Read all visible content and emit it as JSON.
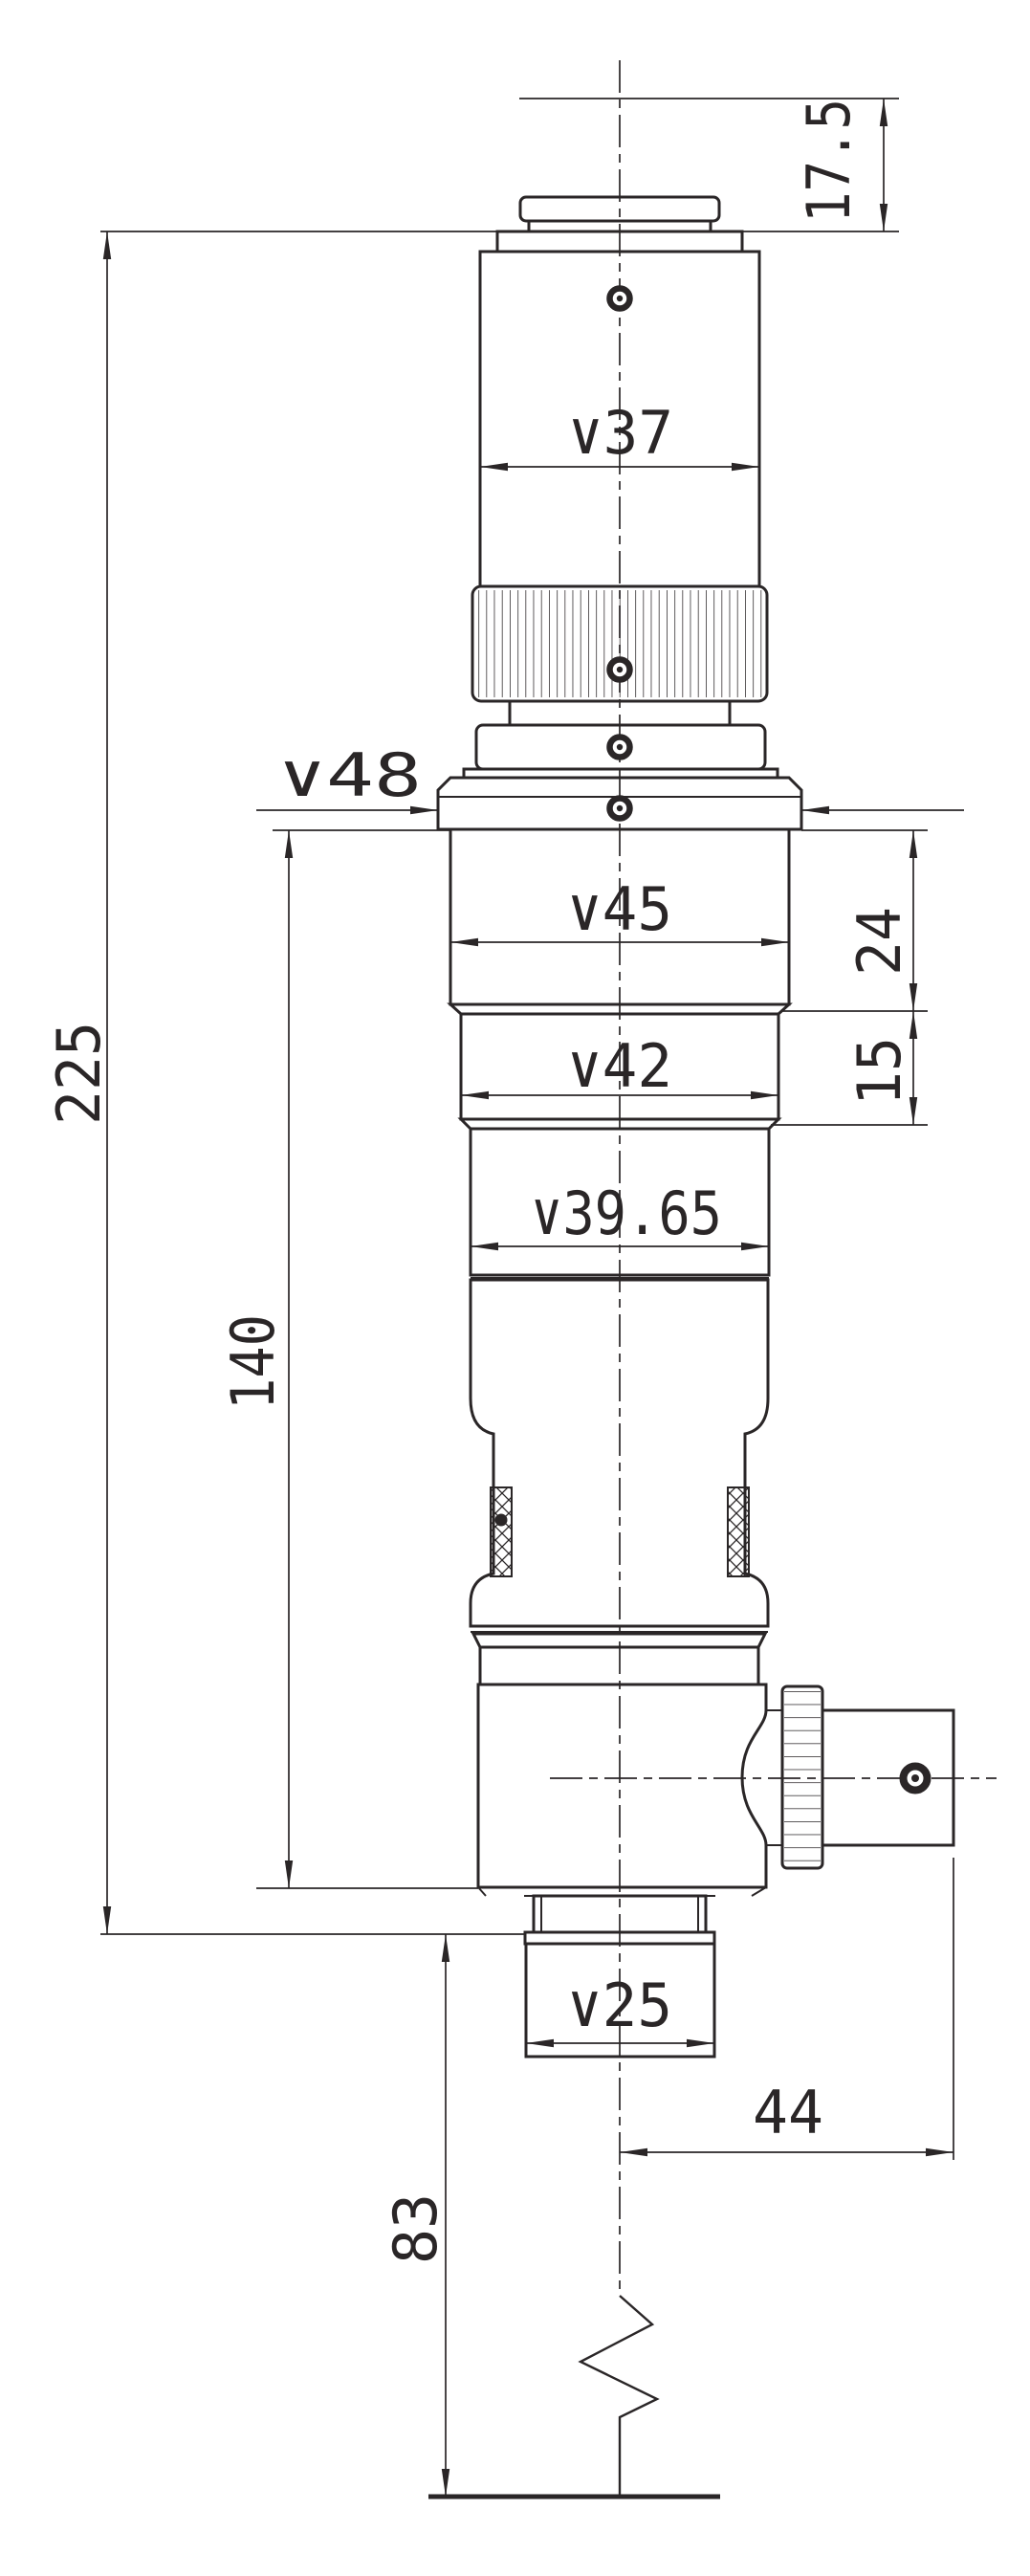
{
  "drawing": {
    "kind": "technical-dimension-drawing",
    "colors": {
      "ink": "#2a2627",
      "paper": "#ffffff"
    },
    "dims": {
      "overall": "225",
      "upper": "140",
      "working": "83",
      "top": "17.5",
      "d37": "∨37",
      "d48": "∨48",
      "d45": "∨45",
      "d42": "∨42",
      "d3965": "∨39.65",
      "d25": "∨25",
      "s24": "24",
      "s15": "15",
      "knob": "44"
    }
  }
}
